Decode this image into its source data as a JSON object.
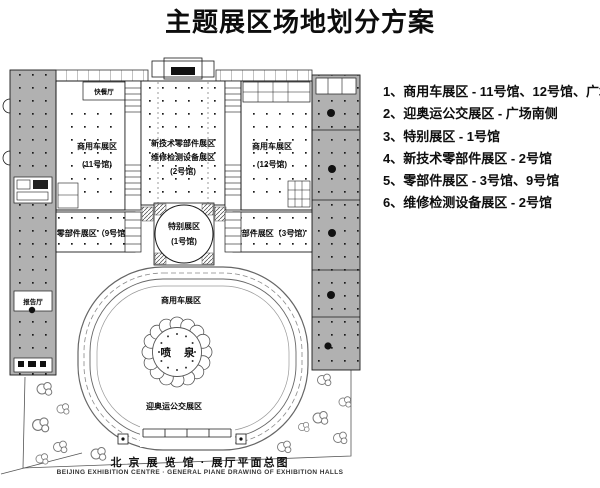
{
  "title": "主题展区场地划分方案",
  "legend": {
    "items": [
      "1、商用车展区 - 11号馆、12号馆、广场",
      "2、迎奥运公交展区 - 广场南侧",
      "3、特别展区 - 1号馆",
      "4、新技术零部件展区 - 2号馆",
      "5、零部件展区 - 3号馆、9号馆",
      "6、维修检测设备展区 - 2号馆"
    ]
  },
  "plan": {
    "labels": {
      "fast_food": "快餐厅",
      "hall11_line1": "商用车展区",
      "hall11_line2": "(11号馆)",
      "hall2_line1": "新技术零部件展区",
      "hall2_line2": "维修检测设备展区",
      "hall2_line3": "(2号馆)",
      "hall12_line1": "商用车展区",
      "hall12_line2": "(12号馆)",
      "hall9": "零部件展区（9号馆）",
      "hall1_line1": "特别展区",
      "hall1_line2": "(1号馆)",
      "hall3": "零部件展区（3号馆）",
      "lecture_hall": "报告厅",
      "plaza_commercial": "商用车展区",
      "fountain": "喷 泉",
      "plaza_olympic": "迎奥运公交展区"
    },
    "colors": {
      "wing_gray": "#b1b1b1",
      "line": "#1a1a1a"
    }
  },
  "footer": {
    "caption_cn": "北 京 展 览 馆 ·  展厅平面总图",
    "caption_en": "BEIJING EXHIBITION CENTRE ·   GENERAL PIANE DRAWING OF EXHIBITION HALLS"
  }
}
